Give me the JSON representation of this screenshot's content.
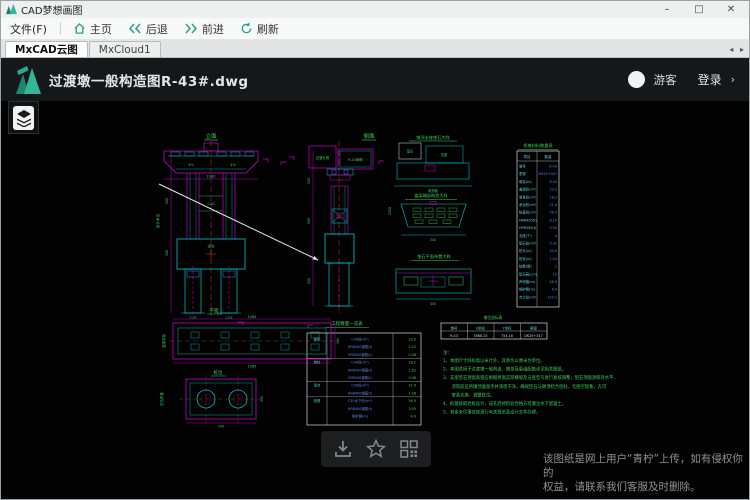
{
  "window": {
    "title": "CAD梦想画图",
    "controls": {
      "minimize": "–",
      "maximize": "□",
      "close": "✕"
    }
  },
  "menubar": {
    "file": "文件(F)",
    "home": "主页",
    "back": "后退",
    "forward": "前进",
    "refresh": "刷新"
  },
  "tabs": {
    "tab1": "MxCAD云图",
    "tab2": "MxCloud1",
    "scroll_arrows": "◂ ▸"
  },
  "viewer_header": {
    "filename": "过渡墩一般构造图R-43#.dwg",
    "guest": "游客",
    "login": "登录",
    "login_arrow": "›"
  },
  "footer": {
    "line1": "该图纸是网上用户“青柠”上传，如有侵权你的",
    "line2": "权益，请联系我们客服及时删除。"
  },
  "colors": {
    "accent_teal": "#2b9e8d",
    "cad_magenta": "#cc00cc",
    "cad_cyan": "#00c8c8",
    "cad_green": "#3fcf5f",
    "cad_red": "#bb3333",
    "cad_blue": "#5b82e8",
    "cad_white": "#e6e6e6"
  },
  "drawing": {
    "labels": {
      "elevation": "立面",
      "side": "侧面",
      "plan1": "平面",
      "plan2": "桩位",
      "box1": "过渡孔侧",
      "box2": "R-43墩侧",
      "d1_title": "墩顶支座垫石大样",
      "d2_title": "盖梁端部构造大样",
      "d3_title": "垫石平面布置大样",
      "notes_head": "注：",
      "vtext_elev": "设计水位",
      "vtext_plan1": "盖梁平面",
      "vtext_plan2": "桩位布置",
      "cap_label": "承台",
      "conc_label": "C40",
      "pier_top": "墩顶面",
      "pad1": "垫石",
      "pad2": "支座"
    },
    "dims": {
      "cap": "1080",
      "col_h": "500",
      "cap_h": "300",
      "pile_l": "C25",
      "pile_r": "C25",
      "grade_l": "4%",
      "grade_r": "4%",
      "side_l1": "150",
      "side_l2": "500",
      "side_l3": "450",
      "side_r": "2450",
      "d2_dim": "240",
      "d3_dim": "400",
      "plan1_dim_top": "1060",
      "plan1_dim_bot": "1060",
      "plan1_side": "160",
      "plan2_dim": "700",
      "plan2_side": "350"
    },
    "materials_table": {
      "title": "桥墩材料数量表",
      "headers": [
        "项目",
        "数量"
      ],
      "rows": [
        [
          "墩号",
          "R-43"
        ],
        [
          "里程",
          "DK25+347"
        ],
        [
          "墩高(m)",
          "6.50"
        ],
        [
          "盖梁砼(m³)",
          "23.5"
        ],
        [
          "墩身砼(m³)",
          "18.2"
        ],
        [
          "承台砼(m³)",
          "21.6"
        ],
        [
          "桩基砼(m³)",
          "56.5"
        ],
        [
          "HRB400(t)",
          "8.10"
        ],
        [
          "HPB300(t)",
          "0.94"
        ],
        [
          "支座(个)",
          "4"
        ],
        [
          "垫石砼(m³)",
          "0.32"
        ],
        [
          "桩长(m)",
          "24.0"
        ],
        [
          "桩径(m)",
          "1.20"
        ],
        [
          "桩数(根)",
          "2"
        ],
        [
          "垫石高(cm)",
          "10"
        ],
        [
          "声测管(m)",
          "48.6"
        ],
        [
          "钢护筒(m)",
          "4.0"
        ],
        [
          "合计砼(m³)",
          "120.1"
        ]
      ]
    },
    "qty_table": {
      "title": "工程数量一览表",
      "rows": [
        [
          "盖梁",
          "C40砼(m³)",
          "23.5"
        ],
        [
          "",
          "HRB400钢筋(t)",
          "2.15"
        ],
        [
          "",
          "HPB300钢筋(t)",
          "0.58"
        ],
        [
          "墩柱",
          "C40砼(m³)",
          "18.2"
        ],
        [
          "",
          "HRB400钢筋(t)",
          "1.62"
        ],
        [
          "",
          "HPB300钢筋(t)",
          "0.36"
        ],
        [
          "承台",
          "C30砼(m³)",
          "21.6"
        ],
        [
          "",
          "HRB400钢筋(t)",
          "1.28"
        ],
        [
          "桩基",
          "C30水下砼(m³)",
          "56.5"
        ],
        [
          "",
          "HRB400钢筋(t)",
          "3.05"
        ],
        [
          "",
          "钢护筒(m)",
          "4.0"
        ]
      ]
    },
    "coord_table": {
      "title": "墩位坐标表",
      "headers": [
        "墩号",
        "X坐标",
        "Y坐标",
        "里程"
      ],
      "row": [
        "R-43",
        "3568.25",
        "754.16",
        "DK25+347"
      ]
    },
    "notes": {
      "lines": [
        "1、本图尺寸除标高以米计外，其余均以厘米为单位。",
        "2、本图适用于过渡墩一般构造，墩身及基础配筋详见相关图纸。",
        "3、支座垫石顶面高程应根据桥面实际横坡及支座型号进行复核调整，垫石顶面须保持水平，",
        "　　浇筑前应将墩顶面凿毛并清理干净，确保垫石与墩顶结合密贴、无脱空现象，方可",
        "　　安装支座、调整就位。",
        "4、桩基按嵌岩桩设计，成孔后经检验合格方可灌注水下混凝土。",
        "5、其余未尽事宜按现行有关规范及设计文件办理。"
      ]
    }
  }
}
